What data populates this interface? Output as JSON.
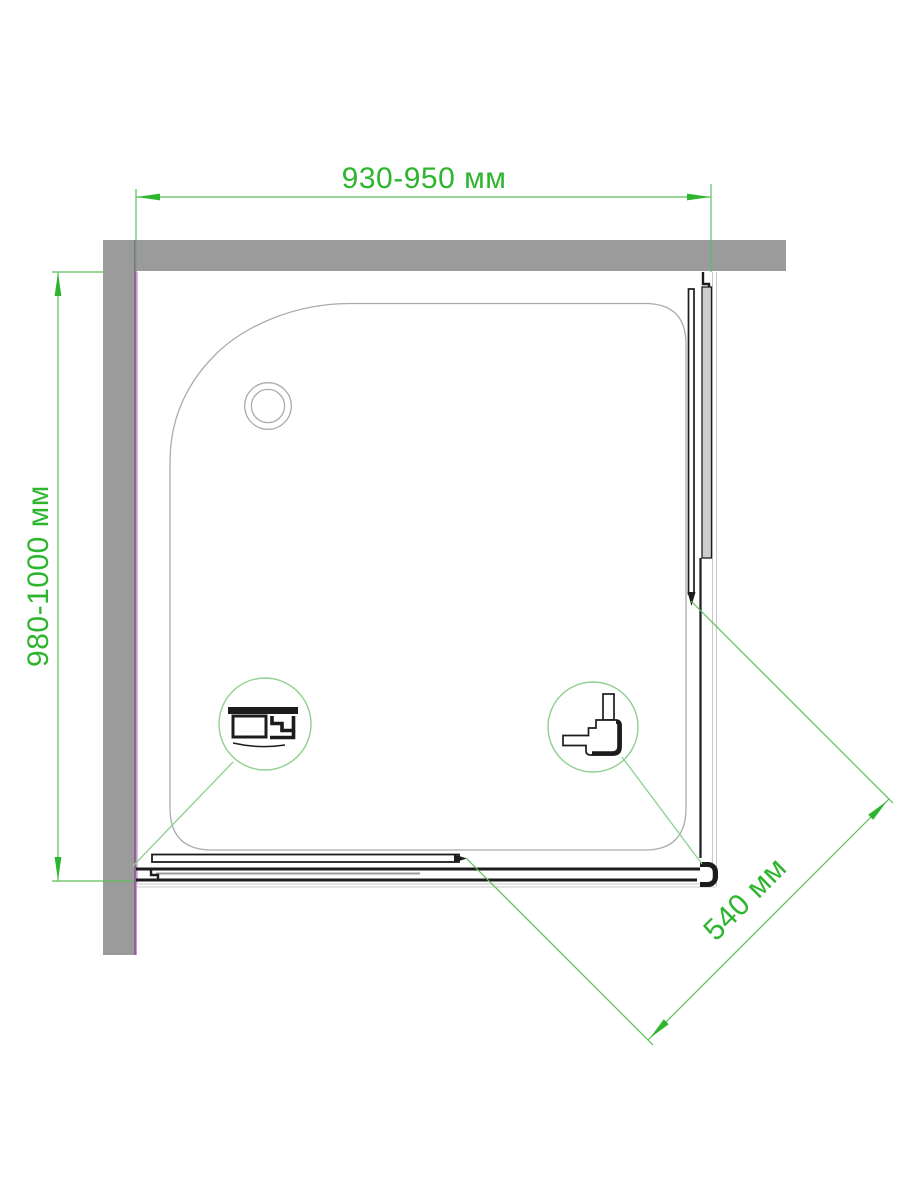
{
  "drawing": {
    "type": "shower-enclosure-top-view",
    "dimensions": {
      "width": {
        "label": "930-950 мм"
      },
      "depth": {
        "label": "980-1000 мм"
      },
      "door_opening": {
        "label": "540 мм"
      }
    }
  },
  "colors": {
    "dim-green": "#2eb52e",
    "line-green": "#5cbf5c",
    "leader-green": "#8fd08f",
    "wall-gray": "#9b9b9b",
    "wall-accent": "#9a5f9a",
    "tray-line": "#ababab",
    "bound-line": "#c9c9c9",
    "panel-gray": "#cdcdcd",
    "drawing-black": "#1c1c1c"
  }
}
